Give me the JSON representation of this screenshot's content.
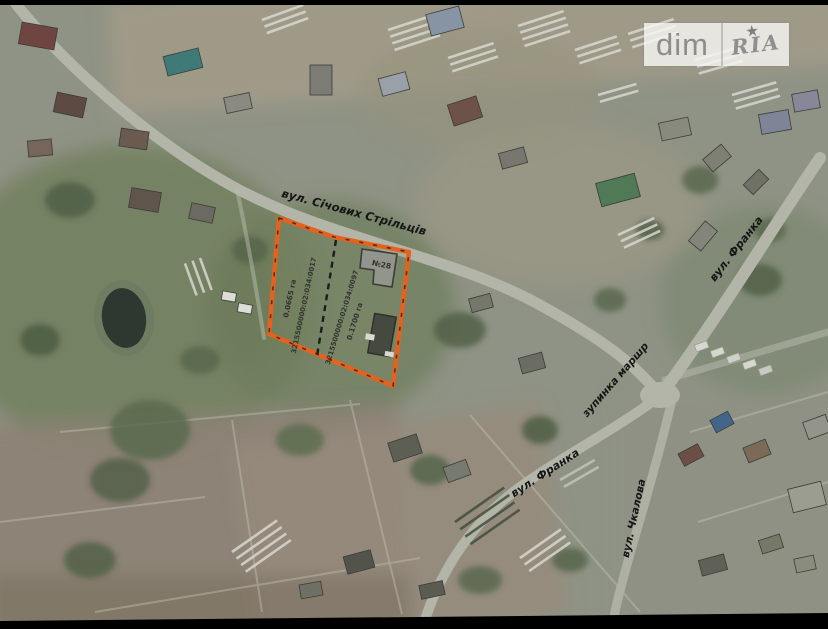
{
  "watermark": {
    "dim": "dim",
    "ria": "RIA",
    "star": "★"
  },
  "map": {
    "streets": {
      "sichovykh": "вул. Січових Стрільців",
      "franka_top": "вул. Франка",
      "bus_stop": "зупинка маршр",
      "franka_bottom": "вул. Франка",
      "chkalova": "вул. Чкалова"
    },
    "parcel": {
      "outline_color": "#E8611C",
      "left_area": "0.0665 га",
      "left_cadastral": "3215500000:02:034:0017",
      "right_cadastral": "3215500000:02:034:0097",
      "right_area": "0.1700 га",
      "house_number": "№28"
    }
  }
}
